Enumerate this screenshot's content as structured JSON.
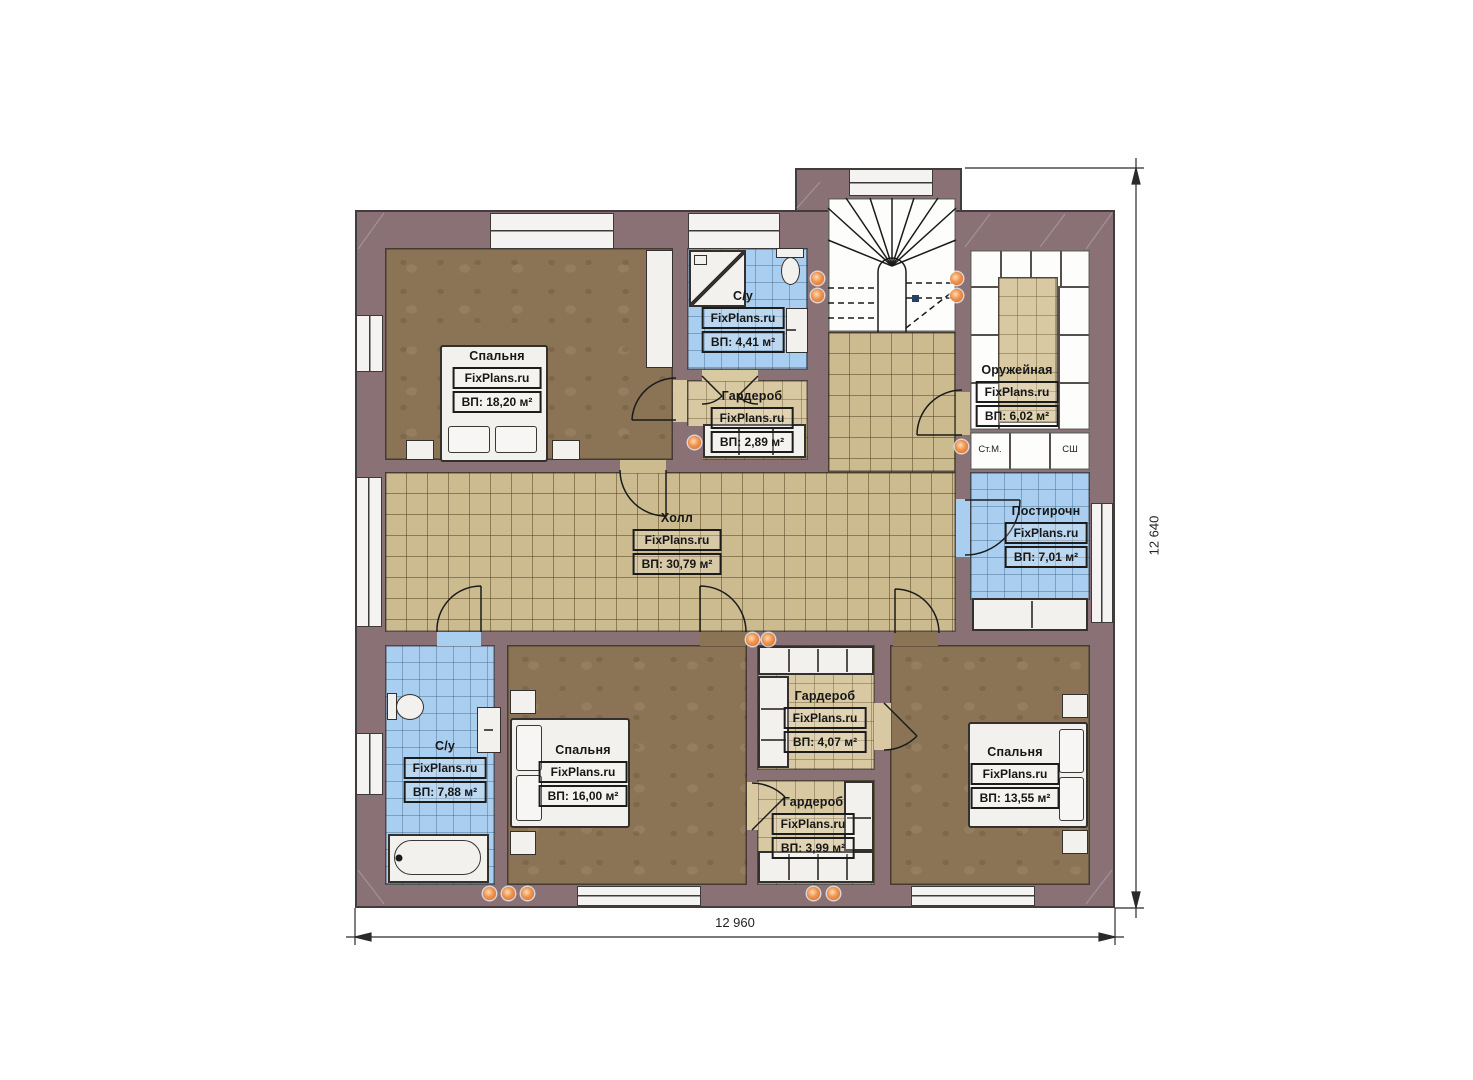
{
  "plan": {
    "brand": "FixPlans.ru",
    "rooms": [
      {
        "key": "bedroom-top-left",
        "name": "Спальня",
        "brand": "FixPlans.ru",
        "area": "ВП: 18,20 м²"
      },
      {
        "key": "bathroom-top",
        "name": "С/у",
        "brand": "FixPlans.ru",
        "area": "ВП: 4,41 м²"
      },
      {
        "key": "wardrobe-top",
        "name": "Гардероб",
        "brand": "FixPlans.ru",
        "area": "ВП: 2,89 м²"
      },
      {
        "key": "armory",
        "name": "Оружейная",
        "brand": "FixPlans.ru",
        "area": "ВП: 6,02 м²"
      },
      {
        "key": "laundry",
        "name": "Постирочн",
        "brand": "FixPlans.ru",
        "area": "ВП: 7,01 м²"
      },
      {
        "key": "hall",
        "name": "Холл",
        "brand": "FixPlans.ru",
        "area": "ВП: 30,79 м²"
      },
      {
        "key": "bathroom-bottom-left",
        "name": "С/у",
        "brand": "FixPlans.ru",
        "area": "ВП: 7,88 м²"
      },
      {
        "key": "bedroom-bottom-middle",
        "name": "Спальня",
        "brand": "FixPlans.ru",
        "area": "ВП: 16,00 м²"
      },
      {
        "key": "wardrobe-middle",
        "name": "Гардероб",
        "brand": "FixPlans.ru",
        "area": "ВП: 4,07 м²"
      },
      {
        "key": "wardrobe-bottom",
        "name": "Гардероб",
        "brand": "FixPlans.ru",
        "area": "ВП: 3,99 м²"
      },
      {
        "key": "bedroom-bottom-right",
        "name": "Спальня",
        "brand": "FixPlans.ru",
        "area": "ВП: 13,55 м²"
      }
    ],
    "appliance_labels": {
      "washing_machine": "Ст.М.",
      "drying_cabinet": "СШ"
    },
    "dimensions": {
      "overall_width": "12 960",
      "overall_height": "12 640"
    },
    "colors": {
      "wall": "#897175",
      "bedroom_floor": "#8b7355",
      "hall_tile": "#cdbb90",
      "wardrobe_tile": "#d8c9a2",
      "wet_room_tile": "#aaceef",
      "fixture_white": "#f2f1ee",
      "accent_dot": "#e2762b"
    }
  }
}
